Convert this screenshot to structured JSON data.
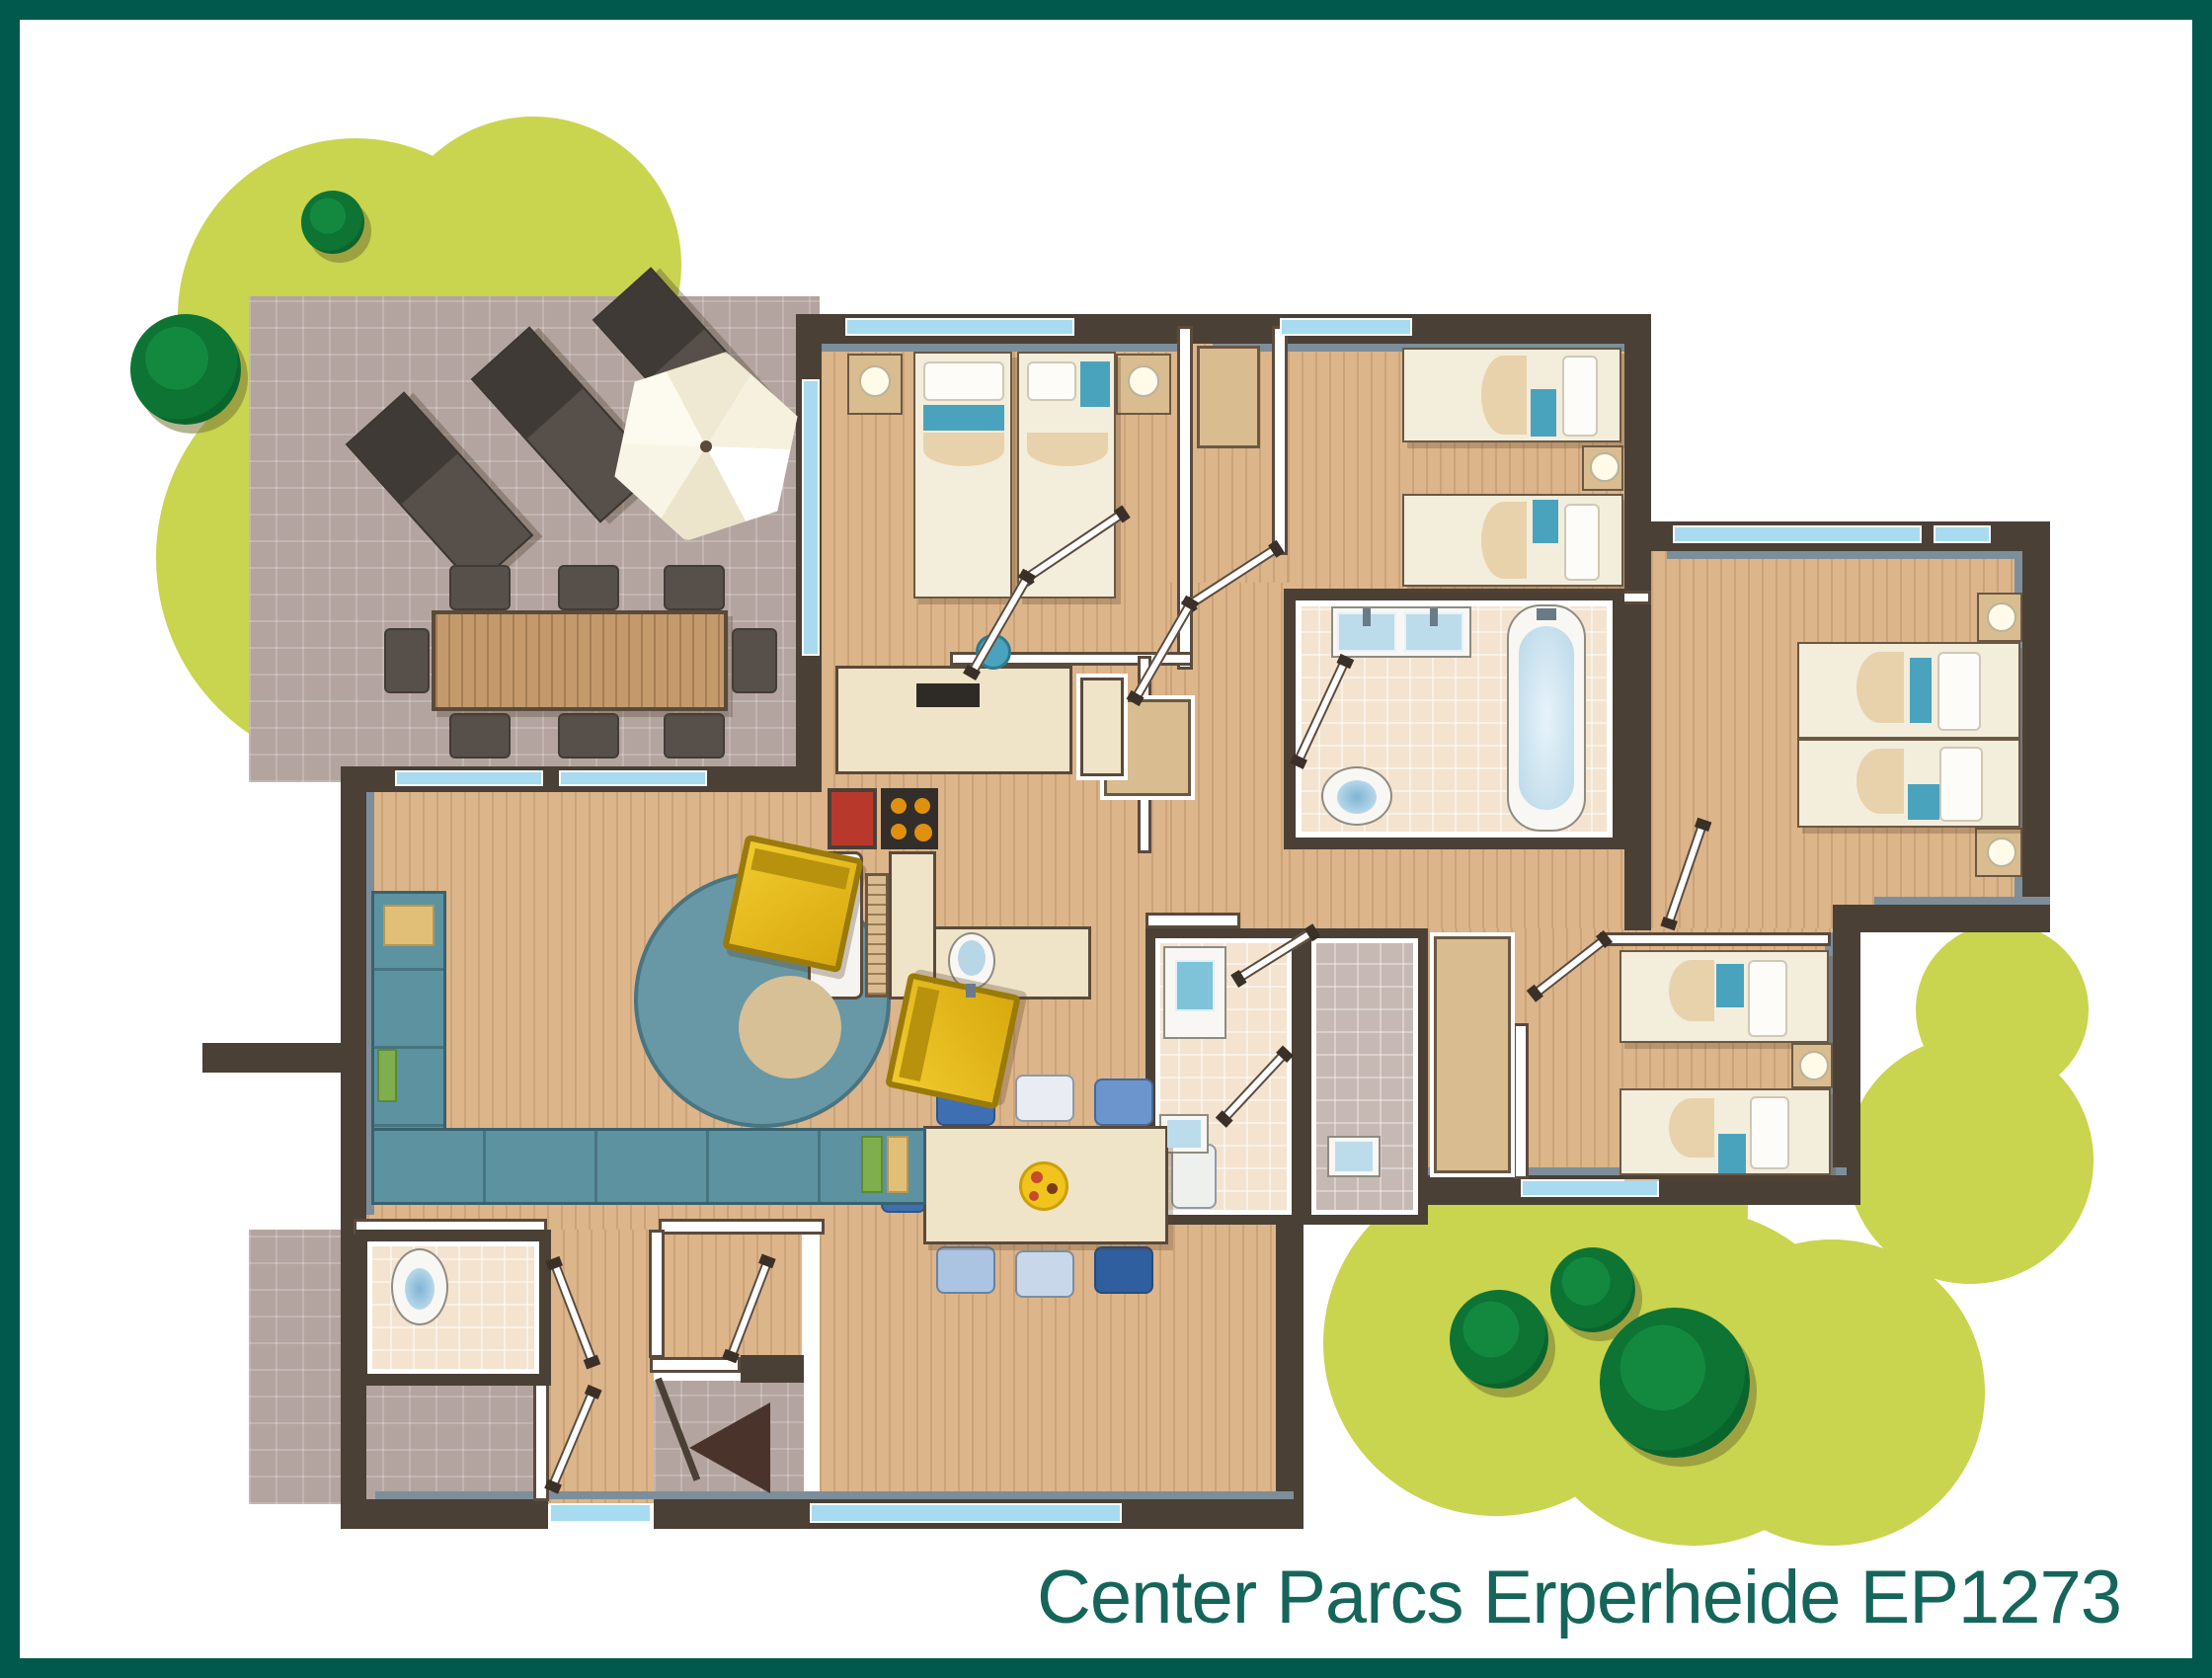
{
  "caption": "Center Parcs Erperheide EP1273",
  "colors": {
    "frame": "#00594c",
    "caption_text": "#15655a",
    "garden": "#c9d44f",
    "tree": "#0d7434",
    "terrace_tile": "#b3a49f",
    "wood_floor": "#dcb58a",
    "wall": "#4a4036",
    "wall_accent": "#7d8e9b",
    "window": "#a8dbef",
    "sofa": "#5d92a1",
    "armchair": "#e7bb1c",
    "bed_accent": "#4aa3bc",
    "kitchen_red": "#b8392c",
    "water": "#cfe6f2"
  },
  "plan": {
    "type": "floor-plan",
    "rooms": [
      {
        "name": "terrace",
        "furniture": [
          "2 sun loungers",
          "parasol",
          "outdoor dining table",
          "8 outdoor chairs"
        ]
      },
      {
        "name": "living-room",
        "furniture": [
          "corner sofa",
          "2 armchairs",
          "round rug"
        ]
      },
      {
        "name": "kitchen",
        "furniture": [
          "hob",
          "sink",
          "fridge",
          "counters",
          "corner unit"
        ]
      },
      {
        "name": "dining-area",
        "furniture": [
          "dining table",
          "8 chairs",
          "pizza plate"
        ]
      },
      {
        "name": "bedroom-1",
        "furniture": [
          "2 single beds",
          "2 nightstands with lamps",
          "washbasin"
        ]
      },
      {
        "name": "bedroom-2",
        "furniture": [
          "2 single beds",
          "nightstand with lamp"
        ]
      },
      {
        "name": "bedroom-3",
        "furniture": [
          "2 single beds",
          "2 nightstands with lamps"
        ]
      },
      {
        "name": "bedroom-4",
        "furniture": [
          "2 single beds",
          "nightstand with lamp"
        ]
      },
      {
        "name": "bathroom",
        "furniture": [
          "bathtub",
          "double washbasin",
          "toilet"
        ]
      },
      {
        "name": "shower-room",
        "furniture": [
          "shower",
          "washbasin"
        ]
      },
      {
        "name": "second-shower-room",
        "furniture": [
          "washbasin"
        ]
      },
      {
        "name": "wc",
        "furniture": [
          "toilet"
        ]
      },
      {
        "name": "hallway",
        "furniture": [
          "wardrobes"
        ]
      },
      {
        "name": "entrance",
        "furniture": [
          "front door",
          "direction arrow"
        ]
      }
    ],
    "outdoor": [
      "garden lawn",
      "5 trees"
    ]
  }
}
